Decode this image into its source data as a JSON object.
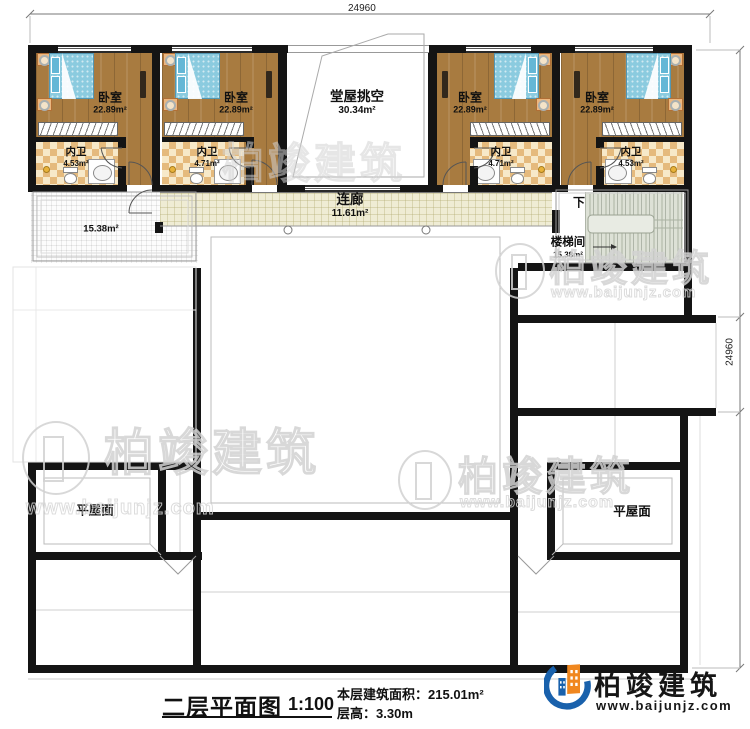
{
  "dimensions": {
    "top": "24960",
    "right": "24960"
  },
  "rooms": {
    "bedrooms": [
      {
        "name": "卧室",
        "area": "22.89m²"
      },
      {
        "name": "卧室",
        "area": "22.89m²"
      },
      {
        "name": "卧室",
        "area": "22.89m²"
      },
      {
        "name": "卧室",
        "area": "22.89m²"
      }
    ],
    "bathrooms": [
      {
        "name": "内卫",
        "area": "4.53m²"
      },
      {
        "name": "内卫",
        "area": "4.71m²"
      },
      {
        "name": "内卫",
        "area": "4.71m²"
      },
      {
        "name": "内卫",
        "area": "4.53m²"
      }
    ],
    "hall": {
      "name": "堂屋挑空",
      "area": "30.34m²"
    },
    "corridor": {
      "name": "连廊",
      "area": "11.61m²"
    },
    "terrace": {
      "area": "15.38m²"
    },
    "stairwell": {
      "name": "楼梯间",
      "area": "15.38m²",
      "down": "下"
    },
    "flat_roofs": [
      {
        "name": "平屋面"
      },
      {
        "name": "平屋面"
      }
    ]
  },
  "title_block": {
    "title": "二层平面图",
    "scale": "1:100",
    "area_label": "本层建筑面积：",
    "area_value": "215.01m²",
    "height_label": "层高：",
    "height_value": "3.30m"
  },
  "brand": {
    "name": "柏竣建筑",
    "website": "www.baijunjz.com"
  },
  "watermark": {
    "name": "柏竣建筑",
    "website": "www.baijunjz.com"
  },
  "colors": {
    "wall": "#141414",
    "wood_floor": "#a87b40",
    "bed": "#8bcbdf",
    "bath_checker": "#e5ba7d",
    "corridor_tile": "#efecd4",
    "stairs": "#dde1d6",
    "logo_blue": "#1961ac",
    "logo_orange": "#f0871f"
  }
}
